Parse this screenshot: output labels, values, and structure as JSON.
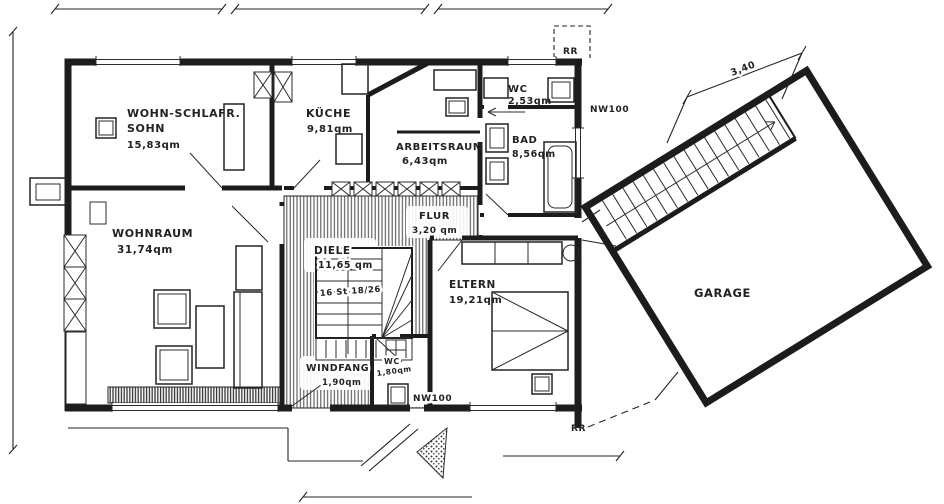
{
  "plan": {
    "rooms": {
      "sohn": {
        "name1": "WOHN-SCHLAFR.",
        "name2": "SOHN",
        "area": "15,83qm"
      },
      "kueche": {
        "name": "KÜCHE",
        "area": "9,81qm"
      },
      "arbeitsraum": {
        "name": "ARBEITSRAUM",
        "area": "6,43qm"
      },
      "wc": {
        "name": "WC",
        "area": "2,53qm"
      },
      "bad": {
        "name": "BAD",
        "area": "8,56qm"
      },
      "wohnraum": {
        "name": "WOHNRAUM",
        "area": "31,74qm"
      },
      "diele": {
        "name": "DIELE",
        "area": "11,65 qm"
      },
      "flur": {
        "name": "FLUR",
        "area": "3,20 qm"
      },
      "eltern": {
        "name": "ELTERN",
        "area": "19,21qm"
      },
      "windfang": {
        "name": "WINDFANG",
        "area": "1,90qm"
      },
      "wc_klein": {
        "name": "WC",
        "area": "1,80qm"
      },
      "garage": {
        "name": "GARAGE"
      }
    },
    "annotations": {
      "stair_note": "16 St 18/26",
      "dim_garage": "3,40",
      "nw100_top": "NW100",
      "nw100_bottom": "NW100",
      "rr_top": "RR",
      "rr_bottom": "RR"
    },
    "colors": {
      "ink": "#1c1c1c",
      "paper": "#ffffff"
    }
  }
}
